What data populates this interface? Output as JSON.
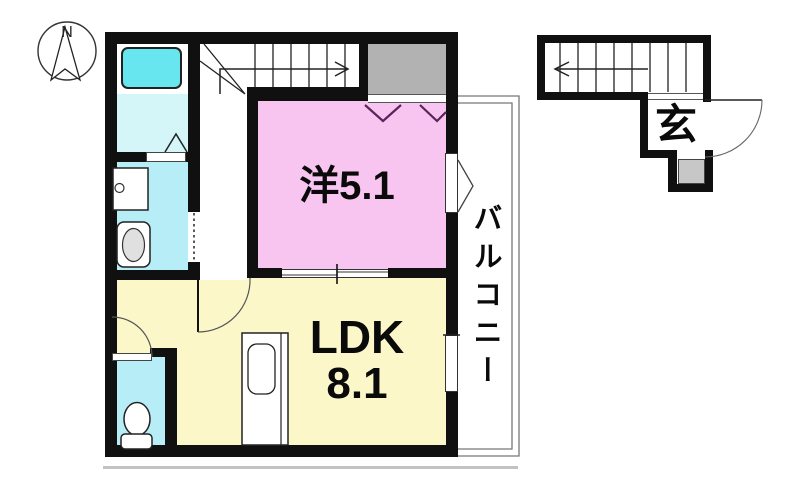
{
  "compass": {
    "north_label": "N"
  },
  "rooms": {
    "western": {
      "label": "洋5.1"
    },
    "ldk": {
      "name": "LDK",
      "size": "8.1"
    },
    "balcony": {
      "label": "バルコニー"
    },
    "entrance": {
      "label": "玄"
    }
  },
  "colors": {
    "wall": "#101010",
    "room-western": "#f8c4f0",
    "room-ldk": "#fbf7c9",
    "bath-tub": "#67e6f0",
    "bath-floor": "#d4f6f9",
    "wet-room": "#b7edf6",
    "storage-gray": "#b2b2b2",
    "porch-gray": "#c7c7c7",
    "window-mark": "#56265a",
    "line": "#222222"
  },
  "fixtures": [
    "compass",
    "bathtub",
    "washbasin",
    "washing-machine",
    "toilet",
    "kitchen-counter",
    "staircase",
    "door-swing",
    "window",
    "porch-step"
  ]
}
